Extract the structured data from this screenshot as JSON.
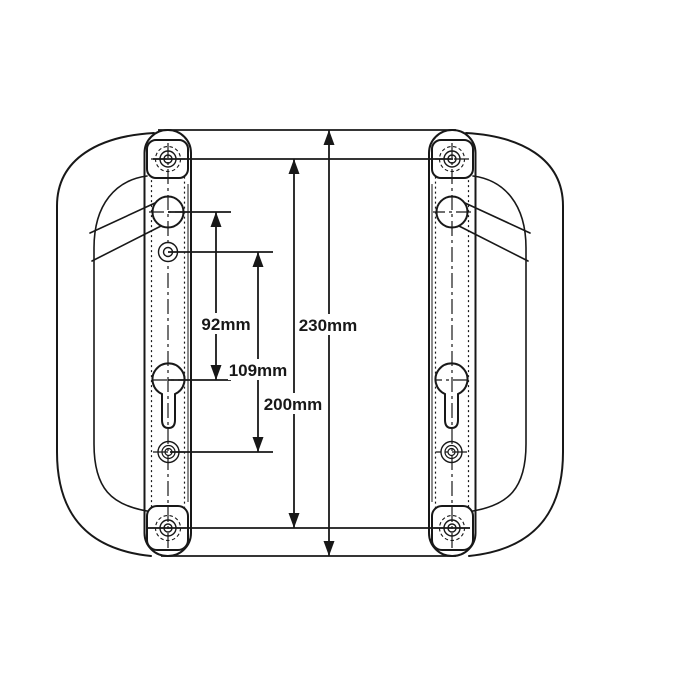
{
  "canvas": {
    "width": 700,
    "height": 700,
    "background": "#ffffff",
    "ink": "#181818"
  },
  "drawing": {
    "type": "technical-dimension-drawing",
    "dimensions": [
      {
        "value": 92,
        "unit": "mm",
        "label": "92mm"
      },
      {
        "value": 109,
        "unit": "mm",
        "label": "109mm"
      },
      {
        "value": 200,
        "unit": "mm",
        "label": "200mm"
      },
      {
        "value": 230,
        "unit": "mm",
        "label": "230mm"
      }
    ]
  }
}
